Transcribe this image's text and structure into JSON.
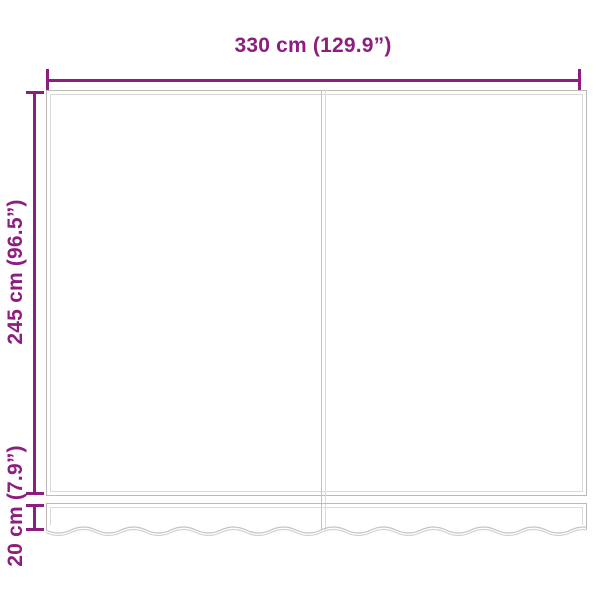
{
  "dimensions": {
    "width": {
      "label": "330 cm (129.9”)"
    },
    "height": {
      "label": "245 cm (96.5”)"
    },
    "valance": {
      "label": "20 cm (7.9”)"
    }
  },
  "colors": {
    "dimension_accent": "#8E1D80",
    "fabric_outline": "#BCB9B6",
    "fabric_outline_light": "#DCDAD7",
    "background": "#FFFFFF"
  },
  "shapes": {
    "fabric_panel": "awning-replacement-fabric",
    "valance_edge": "wavy-scalloped"
  }
}
